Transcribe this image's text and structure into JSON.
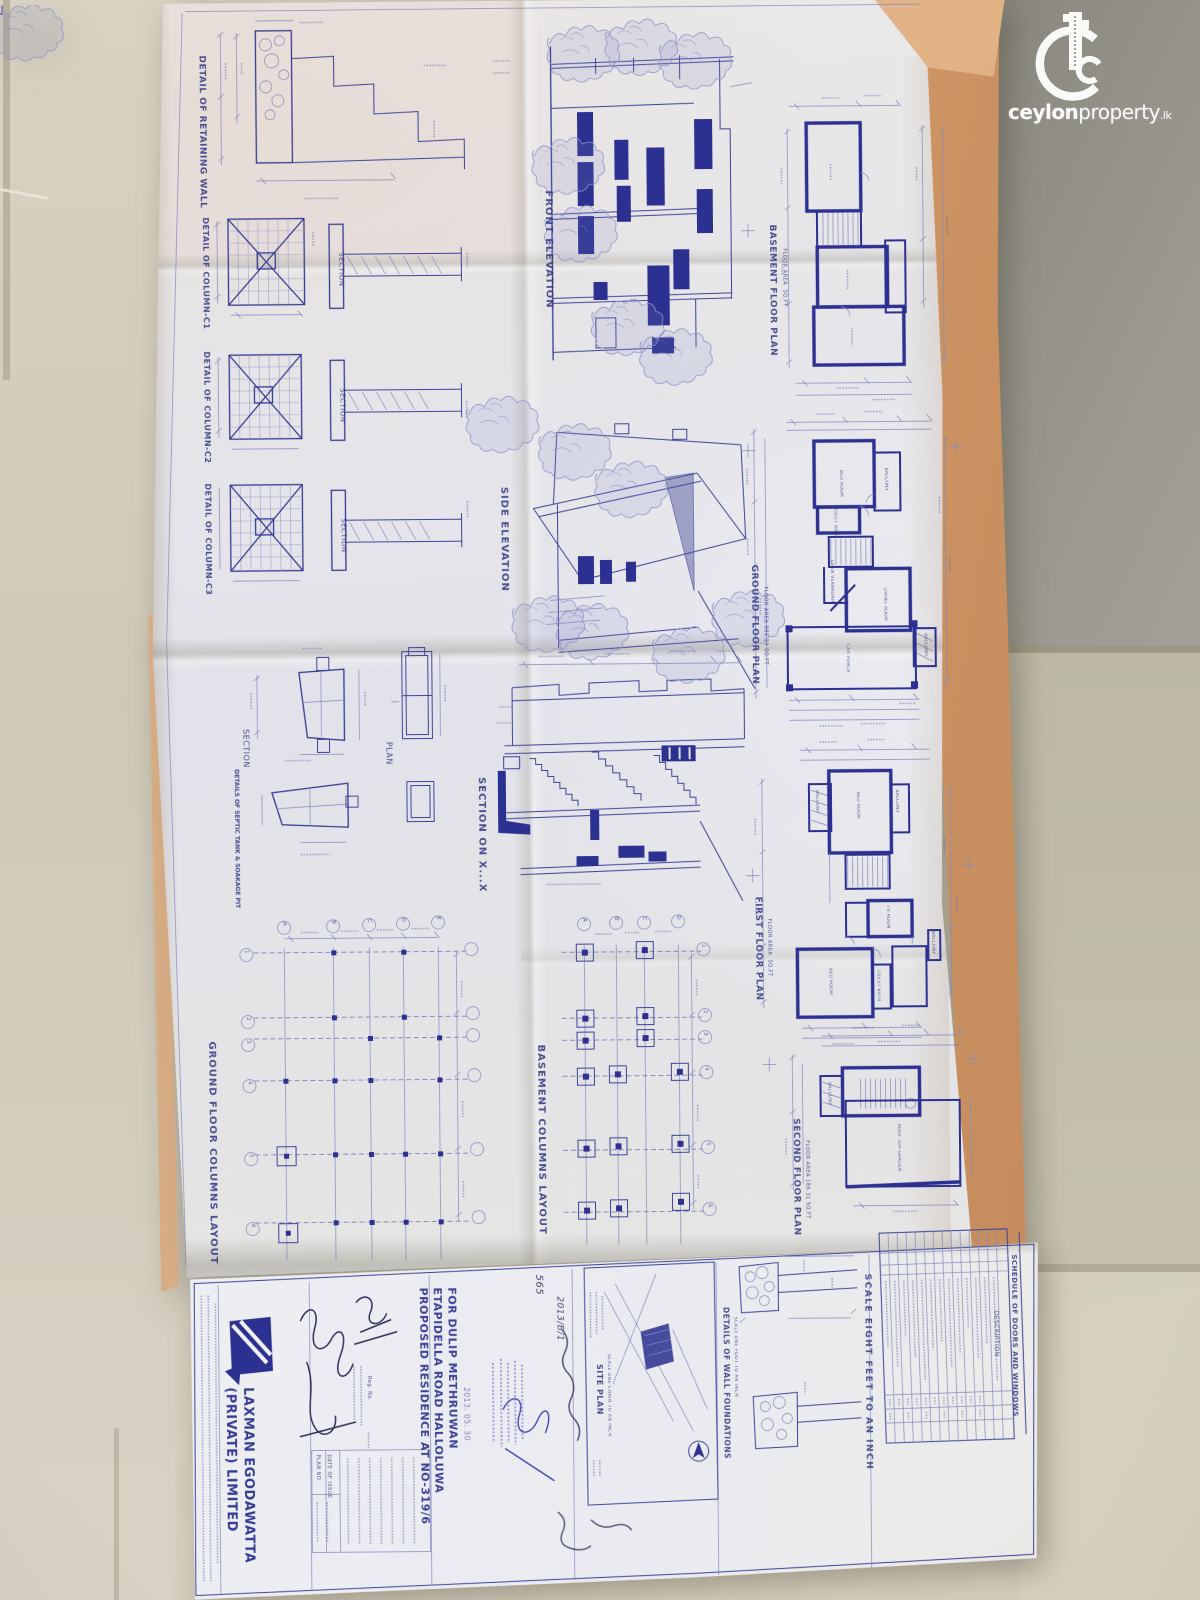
{
  "watermark": {
    "bold": "ceylon",
    "normal": "property",
    "tld": ".lk"
  },
  "captions": {
    "retaining_wall": "DETAIL OF RETAINING WALL",
    "column_c1": "DETAIL OF COLUMN-C1",
    "column_c2": "DETAIL OF COLUMN-C2",
    "column_c3": "DETAIL OF COLUMN-C3",
    "section": "SECTION",
    "septic": "DETAILS OF SEPTIC TANK & SOAKAGE PIT",
    "plan": "PLAN",
    "front_elevation": "FRONT ELEVATION",
    "side_elevation": "SIDE ELEVATION",
    "section_xx": "SECTION ON X...X",
    "ground_columns": "GROUND FLOOR COLUMNS LAYOUT",
    "basement_columns": "BASEMENT COLUMNS LAYOUT",
    "basement_plan": "BASEMENT FLOOR PLAN",
    "ground_plan": "GROUND FLOOR PLAN",
    "first_plan": "FIRST FLOOR PLAN",
    "second_plan": "SECOND FLOOR PLAN",
    "floor_area_ground": "FLOOR AREA 886.29 SQ.FT",
    "floor_area_second": "FLOOR AREA 186.31 SQ.FT",
    "floor_area_generic": "FLOOR AREA  SQ.FT",
    "site_plan": "SITE PLAN",
    "site_plan_scale": "SCALE ONE CHAIN TO AN INCH",
    "wall_foundations": "DETAILS OF WALL FOUNDATIONS",
    "wall_foundations_scale": "SCALE ONE FOOT TO AN INCH",
    "scale_note": "SCALE EIGHT FEET TO AN INCH",
    "schedule_title": "SCHEDULE OF DOORS AND WINDOWS",
    "schedule_description": "DESCRIPTION"
  },
  "rooms": {
    "bed_room": "BED ROOM",
    "living_room": "LIVING ROOM",
    "car_porch": "CAR PORCH",
    "balcony": "BALCONY",
    "toilet_bath": "TOILET BATH",
    "open_verandah": "OPEN VERANDAH",
    "t_v_room": "TV ROOM",
    "roof_top_garden": "ROOF TOP GARDEN"
  },
  "title_block": {
    "project_line1": "PROPOSED RESIDENCE AT NO-319/6",
    "project_line2": "ETAPIDELLA ROAD HALLOLUWA",
    "project_line3": "FOR DULIP METHRUWAN",
    "company_line1": "LAXMAN EGODAWATTA",
    "company_line2": "(PRIVATE) LIMITED",
    "reg_no": "Reg. No.",
    "plan_no": "PLAN NO",
    "date_of_issue": "DATE OF ISSUE",
    "stamp_date": "2013. 05. 30"
  },
  "handwriting": {
    "note_top": "565",
    "note_ref": "2013/B/1"
  },
  "grids": {
    "cols": [
      "A",
      "B",
      "C",
      "D",
      "E"
    ],
    "rows": [
      "1",
      "2",
      "3",
      "4",
      "5",
      "6"
    ]
  }
}
